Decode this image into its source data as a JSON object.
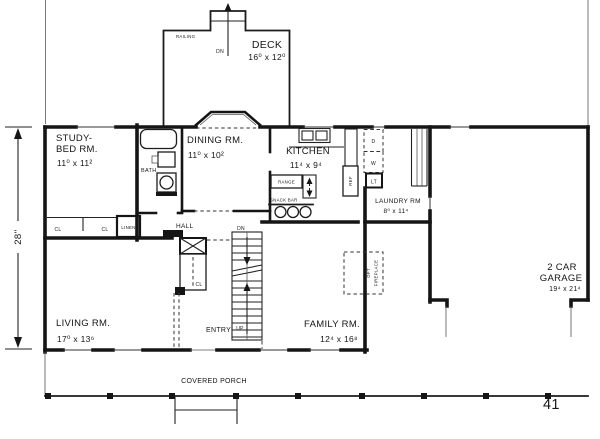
{
  "page_number": "41",
  "dimensions": {
    "left": "28''"
  },
  "deck": {
    "label": "DECK",
    "dims": "16⁰ x 12⁰",
    "railing": "RAILING",
    "down": "DN"
  },
  "study": {
    "line1": "STUDY-",
    "line2": "BED RM.",
    "dims": "11⁰ x 11²"
  },
  "bath": {
    "label": "BATH"
  },
  "dining": {
    "label": "DINING RM.",
    "dims": "11⁰ x 10²"
  },
  "kitchen": {
    "label": "KITCHEN",
    "dims": "11⁴ x 9⁴",
    "range": "RANGE",
    "snack_bar": "SNACK BAR",
    "refrigerator": "REF"
  },
  "hall": {
    "label": "HALL"
  },
  "closets": {
    "cl_left": "CL",
    "cl_right": "CL",
    "linen": "LINEN",
    "entry_closet": "CL"
  },
  "stairs": {
    "down": "DN",
    "up": "UP"
  },
  "laundry": {
    "label": "LAUNDRY RM",
    "dims": "8⁰ x 11⁴",
    "dryer": "D",
    "washer": "W",
    "light": "LT"
  },
  "living": {
    "label": "LIVING RM.",
    "dims": "17⁰ x 13⁶"
  },
  "entry": {
    "label": "ENTRY"
  },
  "family": {
    "label": "FAMILY RM.",
    "dims": "12⁴ x 16⁸"
  },
  "fireplace": {
    "line1": "OPT",
    "line2": "FIREPLACE"
  },
  "porch": {
    "label": "COVERED PORCH"
  },
  "garage": {
    "line1": "2 CAR",
    "line2": "GARAGE",
    "dims": "19⁴ x 21⁴"
  }
}
